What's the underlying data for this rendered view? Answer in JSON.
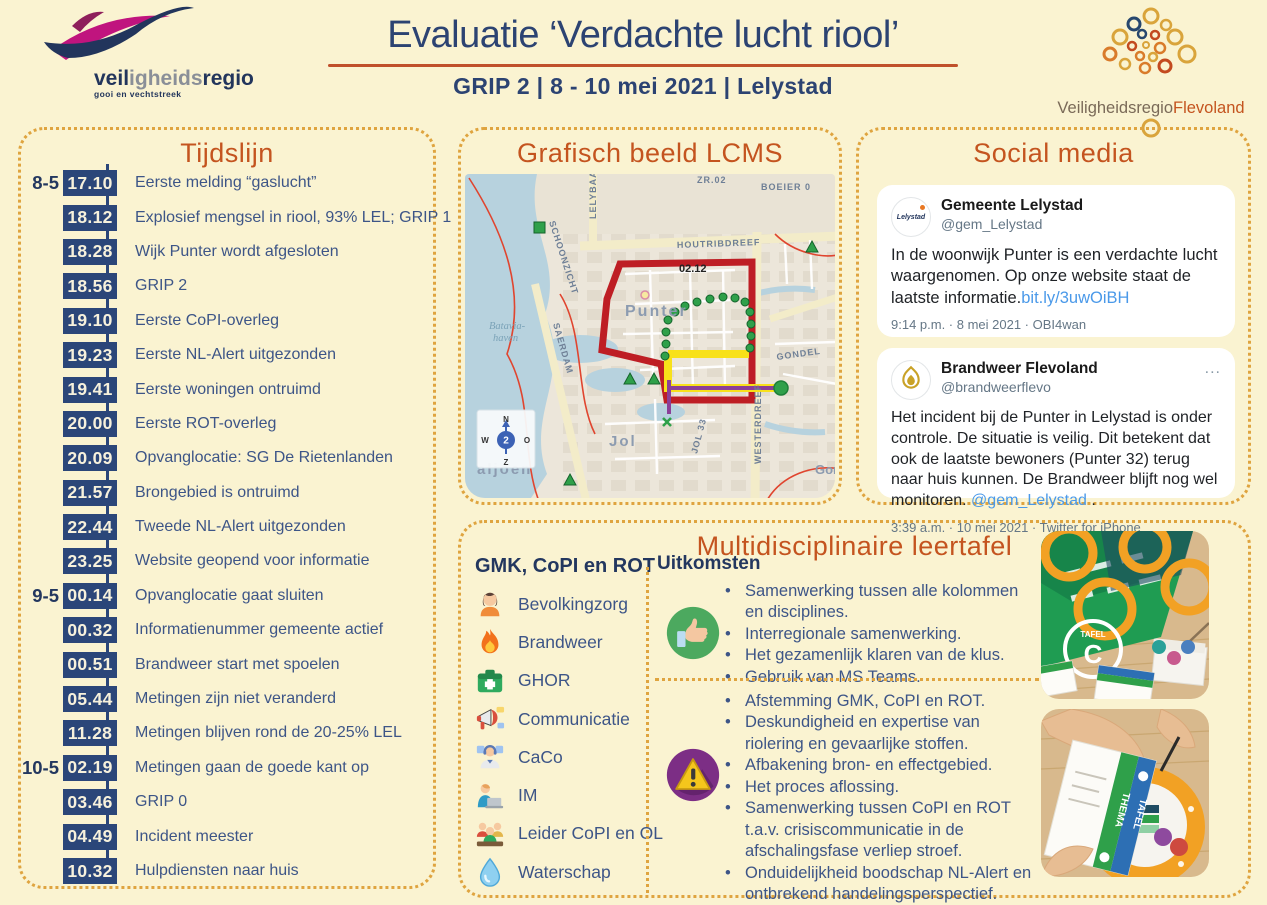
{
  "colors": {
    "background_cream": "#FAF3D1",
    "accent_orange_heading": "#C4541F",
    "navy_text": "#2C4372",
    "dotted_border_gold": "#DFA43F",
    "title_rule_red": "#C0502B",
    "incident_perimeter_red": "#BE1E24",
    "link_blue": "#4A99E9",
    "positive_green": "#4CA95F",
    "negative_purple": "#7C2E85"
  },
  "header": {
    "title": "Evaluatie ‘Verdachte lucht riool’",
    "subtitle": "GRIP 2 | 8 - 10 mei 2021 | Lelystad",
    "logo_left": {
      "part1": "veil",
      "part2": "igheids",
      "part3": "regio",
      "tagline": "gooi en vechtstreek"
    },
    "logo_right": {
      "part1": "Veiligheidsregio",
      "part2": "Flevoland"
    }
  },
  "timeline": {
    "title": "Tijdslijn",
    "items": [
      {
        "day": "8-5",
        "time": "17.10",
        "label": "Eerste melding “gaslucht”"
      },
      {
        "day": "",
        "time": "18.12",
        "label": "Explosief mengsel in riool, 93% LEL; GRIP 1"
      },
      {
        "day": "",
        "time": "18.28",
        "label": "Wijk Punter wordt afgesloten"
      },
      {
        "day": "",
        "time": "18.56",
        "label": "GRIP 2"
      },
      {
        "day": "",
        "time": "19.10",
        "label": "Eerste CoPI-overleg"
      },
      {
        "day": "",
        "time": "19.23",
        "label": "Eerste NL-Alert uitgezonden"
      },
      {
        "day": "",
        "time": "19.41",
        "label": "Eerste woningen ontruimd"
      },
      {
        "day": "",
        "time": "20.00",
        "label": "Eerste ROT-overleg"
      },
      {
        "day": "",
        "time": "20.09",
        "label": "Opvanglocatie: SG De Rietenlanden"
      },
      {
        "day": "",
        "time": "21.57",
        "label": "Brongebied is ontruimd"
      },
      {
        "day": "",
        "time": "22.44",
        "label": "Tweede NL-Alert uitgezonden"
      },
      {
        "day": "",
        "time": "23.25",
        "label": "Website geopend voor informatie"
      },
      {
        "day": "9-5",
        "time": "00.14",
        "label": "Opvanglocatie gaat sluiten"
      },
      {
        "day": "",
        "time": "00.32",
        "label": "Informatienummer gemeente actief"
      },
      {
        "day": "",
        "time": "00.51",
        "label": "Brandweer start met spoelen"
      },
      {
        "day": "",
        "time": "05.44",
        "label": "Metingen zijn niet veranderd"
      },
      {
        "day": "",
        "time": "11.28",
        "label": "Metingen blijven rond de 20-25% LEL"
      },
      {
        "day": "10-5",
        "time": "02.19",
        "label": "Metingen gaan de goede kant op"
      },
      {
        "day": "",
        "time": "03.46",
        "label": "GRIP 0"
      },
      {
        "day": "",
        "time": "04.49",
        "label": "Incident meester"
      },
      {
        "day": "",
        "time": "10.32",
        "label": "Hulpdiensten naar huis"
      }
    ]
  },
  "map_panel": {
    "title": "Grafisch beeld LCMS",
    "labels": {
      "lelybaan": "LELYBAAN",
      "schoonzicht": "SCHOONZICHT",
      "boeier": "BOEIER 0",
      "zr": "ZR.02",
      "houtribdreef": "HOUTRIBDREEF",
      "code": "02.12",
      "punter": "Punter",
      "batavia1": "Batavia-",
      "batavia2": "haven",
      "saerdam": "SAERDAM",
      "jol": "Jol",
      "galjoen": "aljoen",
      "gondel": "GONDEL",
      "westerdreef": "WESTERDREEF",
      "jol33": "JOL 33",
      "gond2": "Gond"
    },
    "compass": {
      "n": "N",
      "o": "O",
      "z": "Z",
      "w": "W",
      "value": "2"
    }
  },
  "social": {
    "title": "Social media",
    "tweets": [
      {
        "avatar_text": "Lelystad",
        "name": "Gemeente Lelystad",
        "handle": "@gem_Lelystad",
        "text": "In de woonwijk Punter is een verdachte lucht waargenomen. Op  onze website staat de laatste informatie.",
        "link": "bit.ly/3uwOiBH",
        "link_suffix": "",
        "meta": "9:14 p.m. · 8 mei 2021 · OBI4wan"
      },
      {
        "name": "Brandweer Flevoland",
        "handle": "@brandweerflevo",
        "menu": "...",
        "text": "Het incident bij de Punter in Lelystad is onder controle. De situatie is veilig. Dit betekent dat ook de laatste bewoners (Punter 32) terug naar huis kunnen. De Brandweer blijft nog wel monitoren. ",
        "link": "@gem_Lelystad",
        "link_suffix": " .",
        "meta": "3:39 a.m. · 10 mei 2021 · Twitter for iPhone"
      }
    ]
  },
  "leertafel": {
    "title": "Multidisciplinaire leertafel",
    "roles_header": "GMK, CoPI en ROT",
    "roles": [
      {
        "icon": "person-icon",
        "label": "Bevolkingzorg"
      },
      {
        "icon": "flame-icon",
        "label": "Brandweer"
      },
      {
        "icon": "firstaid-icon",
        "label": "GHOR"
      },
      {
        "icon": "megaphone-icon",
        "label": "Communicatie"
      },
      {
        "icon": "operator-icon",
        "label": "CaCo"
      },
      {
        "icon": "laptop-icon",
        "label": "IM"
      },
      {
        "icon": "group-icon",
        "label": "Leider CoPI en OL"
      },
      {
        "icon": "droplet-icon",
        "label": "Waterschap"
      }
    ],
    "outcomes_header": "Uitkomsten",
    "positives": [
      "Samenwerking tussen alle kolommen en disciplines.",
      "Interregionale samenwerking.",
      "Het gezamenlijk klaren van de klus.",
      "Gebruik van MS Teams."
    ],
    "negatives": [
      "Afstemming GMK, CoPI en ROT.",
      "Deskundigheid en expertise van riolering en gevaarlijke stoffen.",
      "Afbakening bron- en effectgebied.",
      "Het proces aflossing.",
      "Samenwerking tussen CoPI en ROT t.a.v. crisiscommunicatie in de afschalingsfase verliep stroef.",
      "Onduidelijkheid boodschap NL-Alert en ontbrekend handelingsperspectief."
    ],
    "photos": [
      {
        "board_label": "TAFEL",
        "board_letter": "C"
      },
      {
        "card_label_1": "TAFEL",
        "card_label_2": "THEMA"
      }
    ]
  }
}
